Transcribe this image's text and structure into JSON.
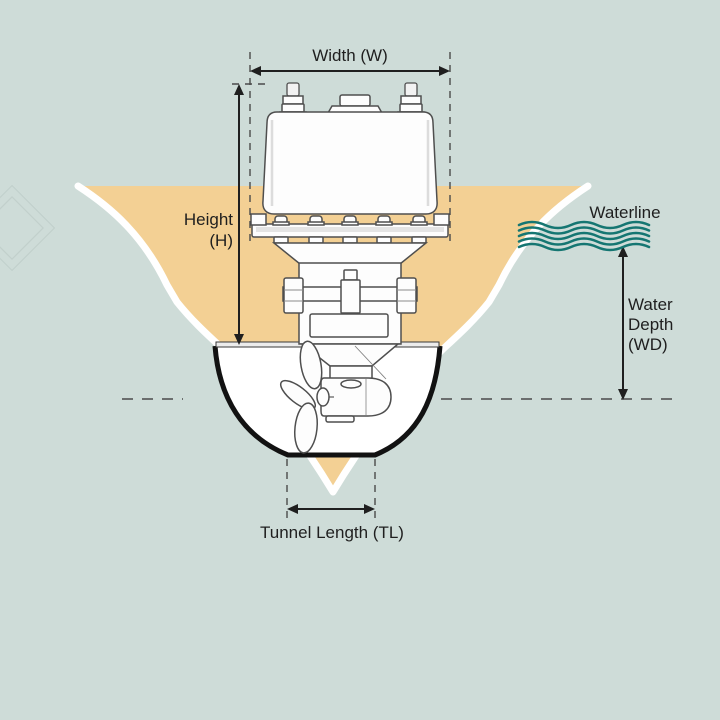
{
  "labels": {
    "width": "Width (W)",
    "height": {
      "line1": "Height",
      "line2": "(H)"
    },
    "waterline": "Waterline",
    "water_depth": {
      "line1": "Water",
      "line2": "Depth",
      "line3": "(WD)"
    },
    "tunnel_length": "Tunnel Length (TL)"
  },
  "colors": {
    "background": "#cedcd8",
    "hull_fill": "#f3d094",
    "hull_outline": "#ffffff",
    "tunnel_stroke": "#121212",
    "machine_stroke": "#4f4f4f",
    "wave_teal": "#157672",
    "annotation": "#1f1f1f",
    "dash": "#4a4a4a"
  }
}
